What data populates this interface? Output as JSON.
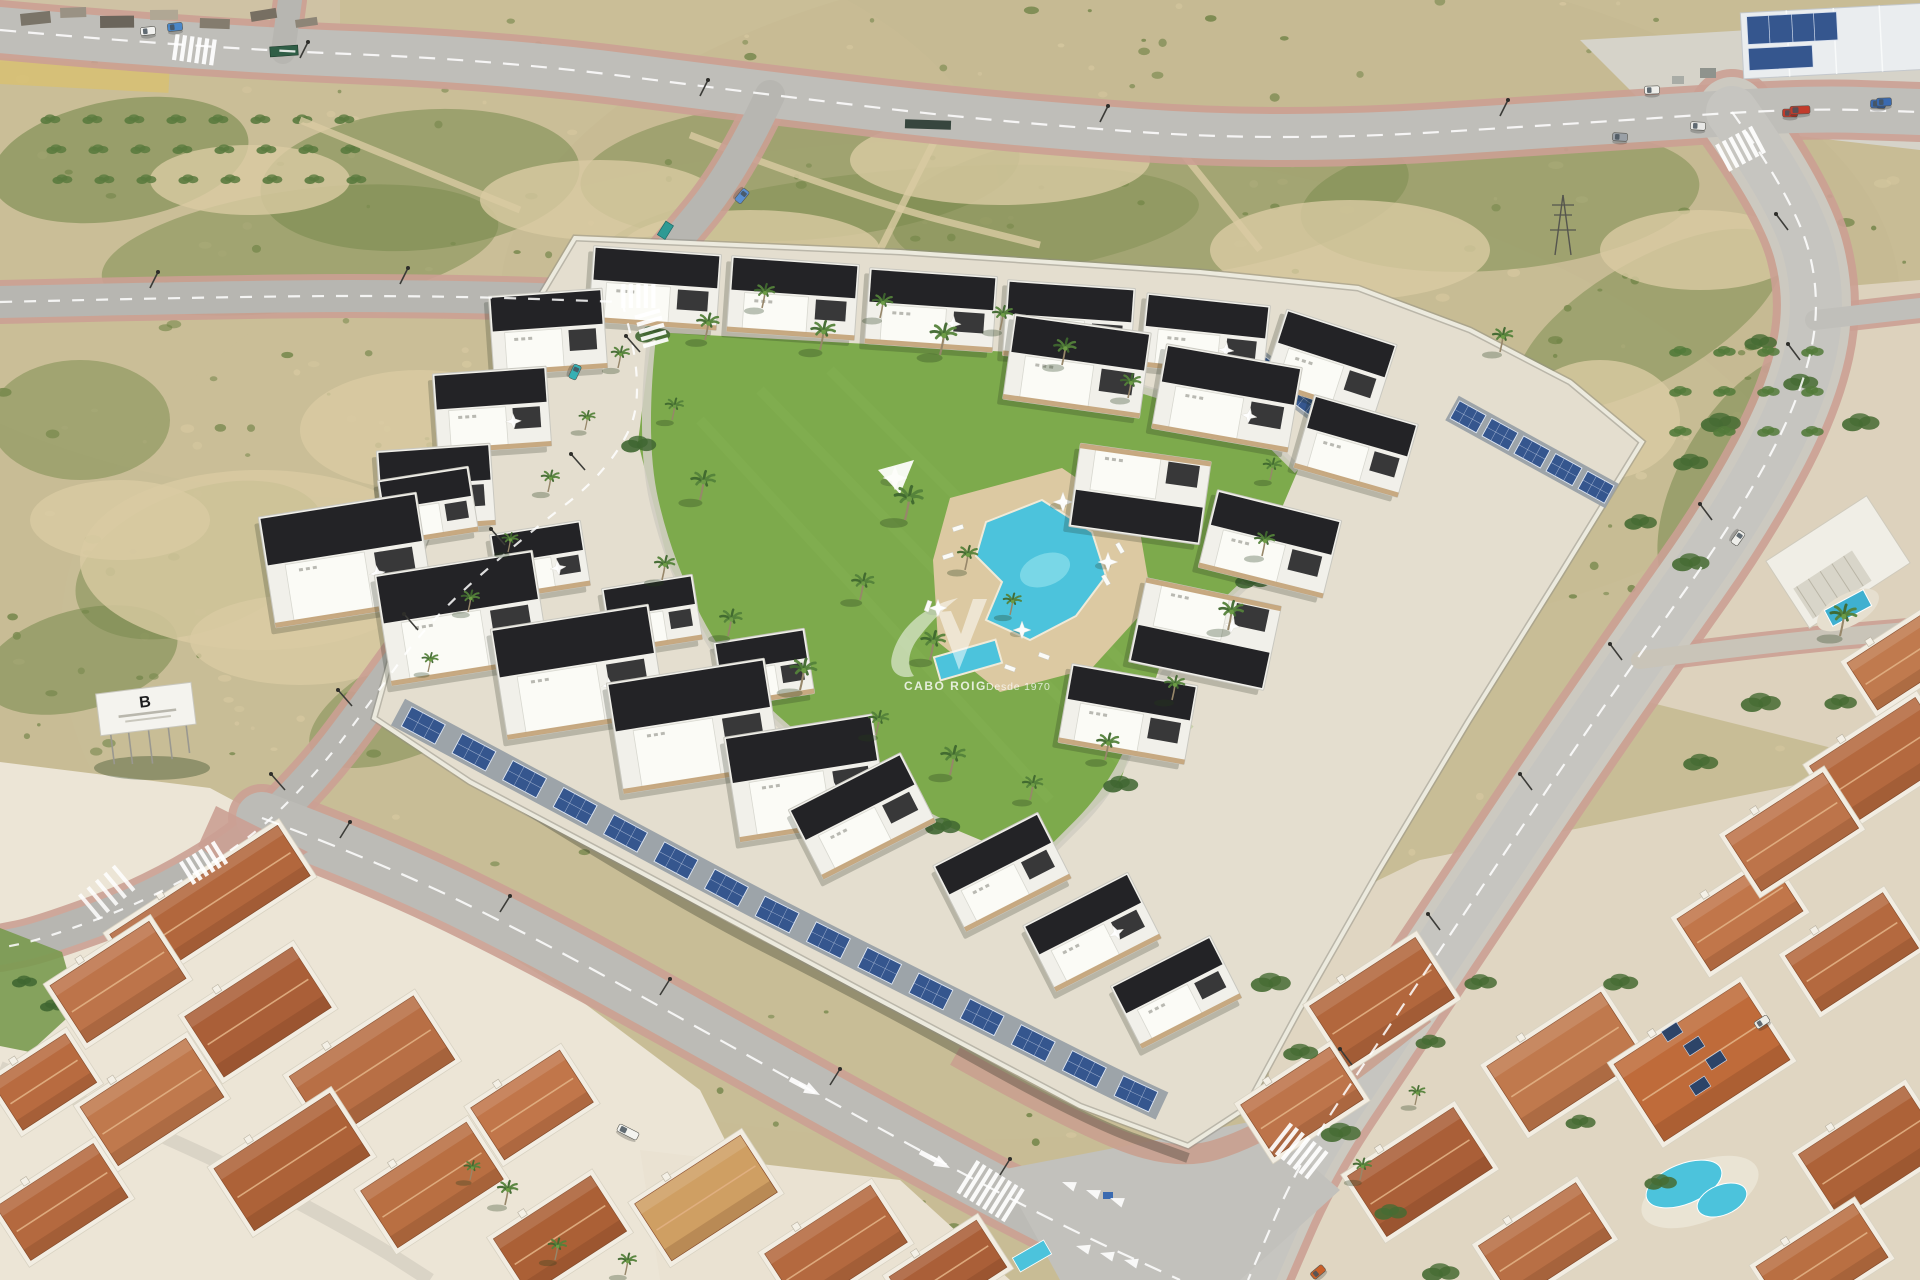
{
  "watermark": {
    "brand": "CABO ROIG",
    "tagline": "Desde 1970",
    "logo_name": "swoosh-logo"
  },
  "billboard": {
    "letter": "B"
  },
  "colors": {
    "sand": "#cfc0a0",
    "scrub_green": "#6d8144",
    "dirt": "#d9caa2",
    "asphalt": "#b7b6b1",
    "asphalt_light": "#c6c5c0",
    "sidewalk": "#cba093",
    "lawn": "#7daa4c",
    "pool_water": "#4cc3dc",
    "pool_deck": "#dcc9a2",
    "building_white": "#f1f0ea",
    "roof_black": "#232326",
    "terracotta": "#b2673d",
    "solar_panel": "#35568e",
    "palm_green": "#47702f",
    "wall_light": "#eceade",
    "watermark_white": "#ffffff"
  }
}
